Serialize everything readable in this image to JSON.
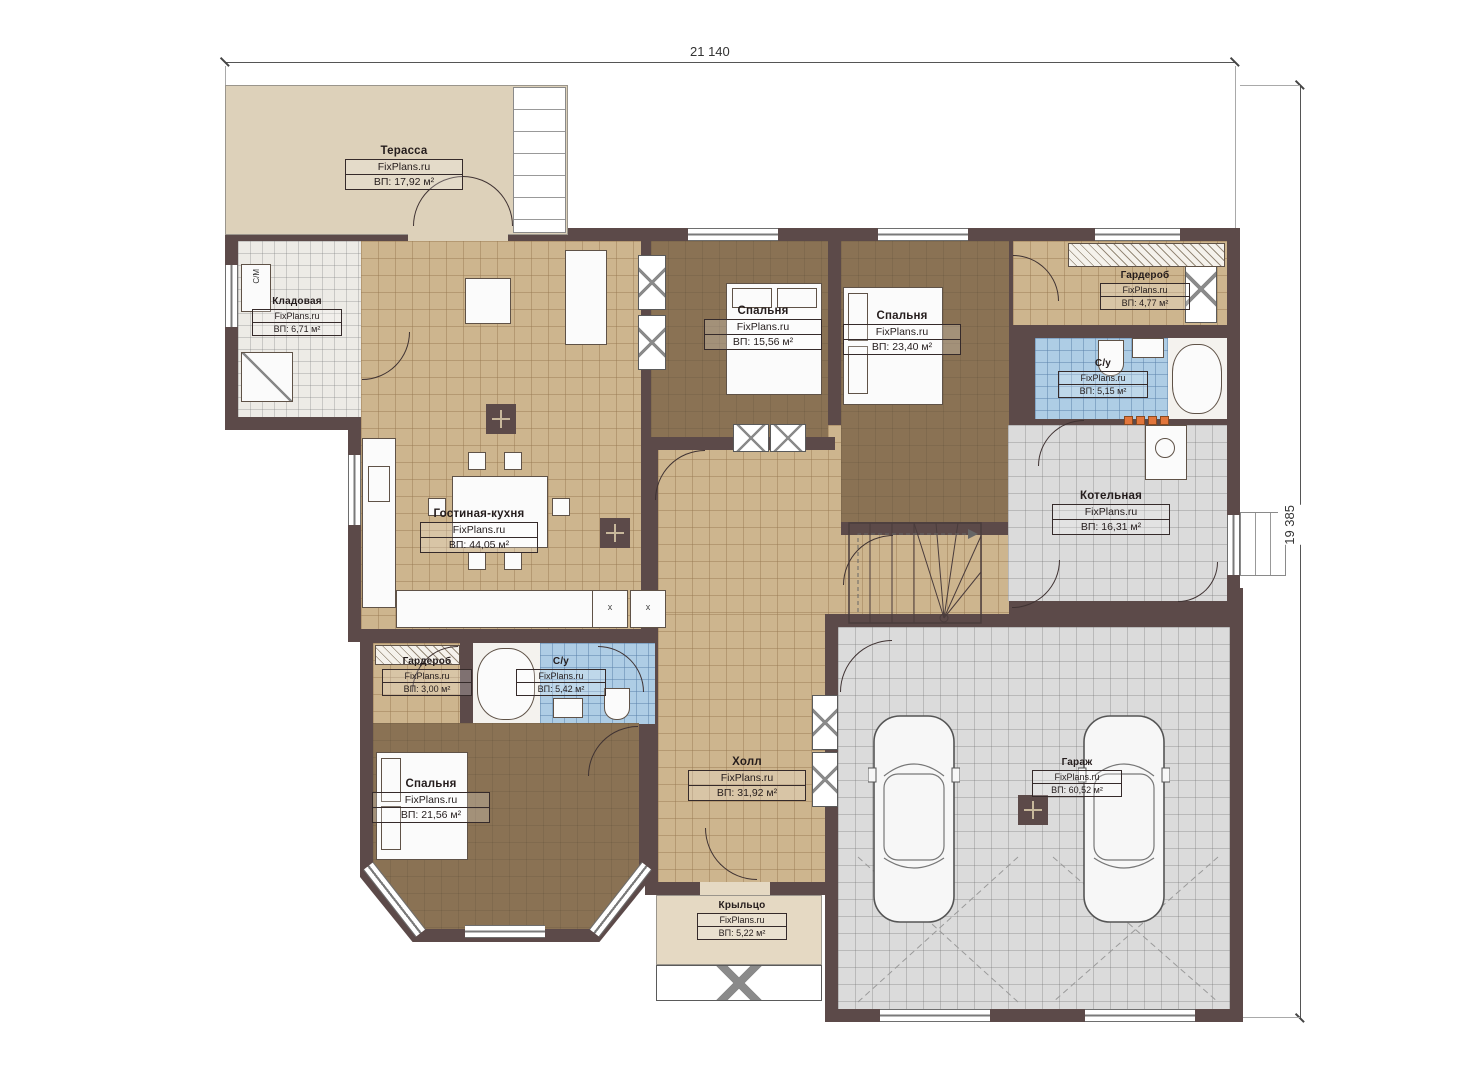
{
  "plan": {
    "watermark": "FixPlans.ru",
    "dimensions": {
      "top": "21 140",
      "right": "19 385"
    },
    "rooms": [
      {
        "name": "Терасса",
        "area": "ВП: 17,92 м²"
      },
      {
        "name": "Кладовая",
        "area": "ВП: 6,71 м²"
      },
      {
        "name": "Спальня",
        "area": "ВП: 15,56 м²"
      },
      {
        "name": "Спальня",
        "area": "ВП: 23,40 м²"
      },
      {
        "name": "Гардероб",
        "area": "ВП: 4,77 м²"
      },
      {
        "name": "С/у",
        "area": "ВП: 5,15 м²"
      },
      {
        "name": "Котельная",
        "area": "ВП: 16,31 м²"
      },
      {
        "name": "Гостиная-кухня",
        "area": "ВП: 44,05 м²"
      },
      {
        "name": "Гардероб",
        "area": "ВП: 3,00 м²"
      },
      {
        "name": "С/у",
        "area": "ВП: 5,42 м²"
      },
      {
        "name": "Спальня",
        "area": "ВП: 21,56 м²"
      },
      {
        "name": "Холл",
        "area": "ВП: 31,92 м²"
      },
      {
        "name": "Гараж",
        "area": "ВП: 60,52 м²"
      },
      {
        "name": "Крыльцо",
        "area": "ВП: 5,22 м²"
      }
    ],
    "labels": {
      "washing_machine": "С/М",
      "appliance_mark": "x"
    },
    "colors": {
      "wall": "#5c4a49",
      "floor_tan": "#cdb58e",
      "floor_brown": "#8a7254",
      "floor_blue": "#aecde5",
      "floor_gray": "#dbdbdb",
      "terrace": "#ddd1ba",
      "accent_orange": "#e2763c"
    }
  }
}
